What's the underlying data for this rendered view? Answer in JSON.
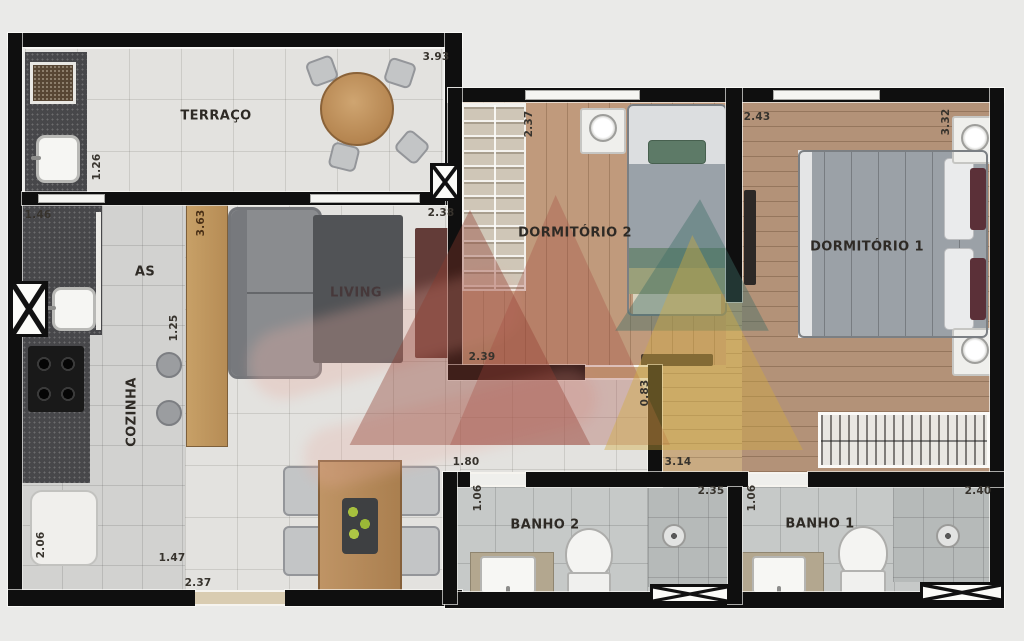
{
  "plan_title": "Apartment floor plan",
  "rooms": {
    "terraco": {
      "label": "TERRAÇO"
    },
    "servico": {
      "label": "AS"
    },
    "cozinha": {
      "label": "COZINHA"
    },
    "living": {
      "label": "LIVING"
    },
    "dorm2": {
      "label": "DORMITÓRIO 2"
    },
    "dorm1": {
      "label": "DORMITÓRIO 1"
    },
    "banho2": {
      "label": "BANHO 2"
    },
    "banho1": {
      "label": "BANHO 1"
    }
  },
  "dims": {
    "terraco_top": "3.93",
    "churrasqueira_side": "1.26",
    "servico_top": "1.46",
    "balcao_side": "3.63",
    "balcao_lower": "1.25",
    "living_top": "2.38",
    "dorm2_side": "2.37",
    "dorm2_bottom": "2.39",
    "dorm1_top": "2.43",
    "dorm1_side": "3.32",
    "hall_side": "0.83",
    "hall_bottom": "3.14",
    "sala_bottom": "1.80",
    "banho2_side": "1.06",
    "banho2_top": "2.35",
    "banho1_side": "1.06",
    "banho1_top": "2.40",
    "cozinha_side": "2.06",
    "cozinha_bottom": "1.47",
    "entrada_bottom": "2.37"
  },
  "colors": {
    "wall": "#0f0f0f",
    "tile-light": "#e3e2df",
    "tile-gray": "#d2d2d0",
    "tile-bath": "#c6c9c8",
    "wood-dorm2": "#c09a7c",
    "wood-dorm1": "#b39278",
    "wood-hall": "#c9ab82",
    "counter": "#47474a",
    "bar-wood": "#c7a067",
    "watermark-red": "#8e392c",
    "watermark-teal": "#3f6e66",
    "watermark-yellow": "#d2ab41",
    "ink": "#2e2a25"
  }
}
